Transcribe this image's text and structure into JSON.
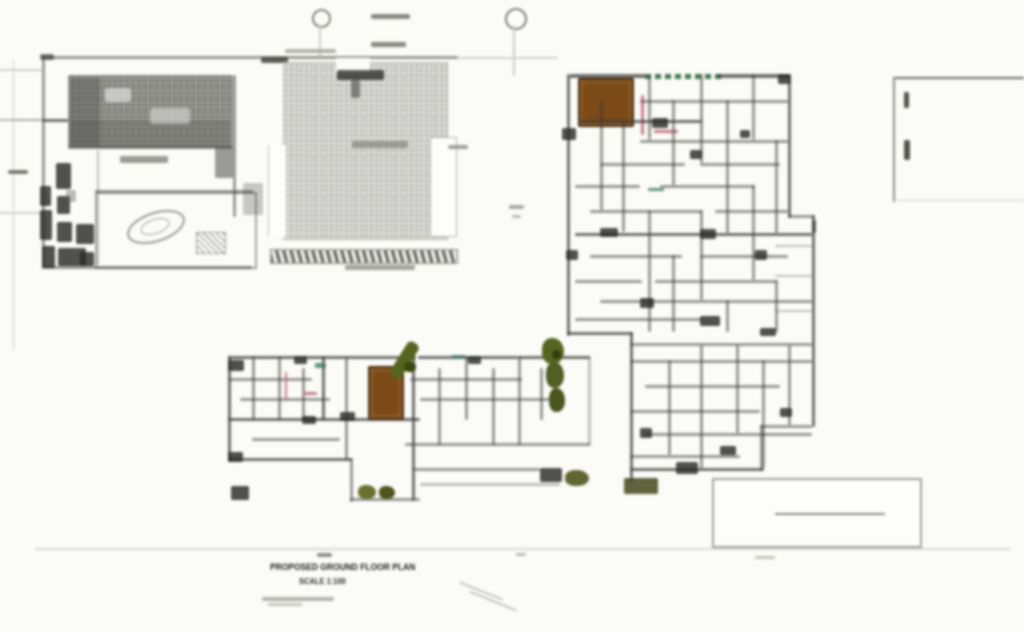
{
  "captions": {
    "drawing_title": "PROPOSED GROUND FLOOR PLAN",
    "drawing_scale": "SCALE 1:100"
  },
  "colors": {
    "paper": "#fbfbf8",
    "ink": "#3a3a38",
    "faint_line": "#cfcfc9",
    "hatch_dark_base": "#a2a29d",
    "hatch_dark_dot": "#5c5c58",
    "hatch_light_base": "#d7d7d3",
    "hatch_light_dot": "#a6a6a1",
    "core_brown": "#7c4a16",
    "core_brown_border": "#46290a",
    "tree_olive": "#57641f",
    "tree_olive_dark": "#3c470f",
    "planting_green": "#3f7a50",
    "accent_pink": "#c26a76"
  }
}
